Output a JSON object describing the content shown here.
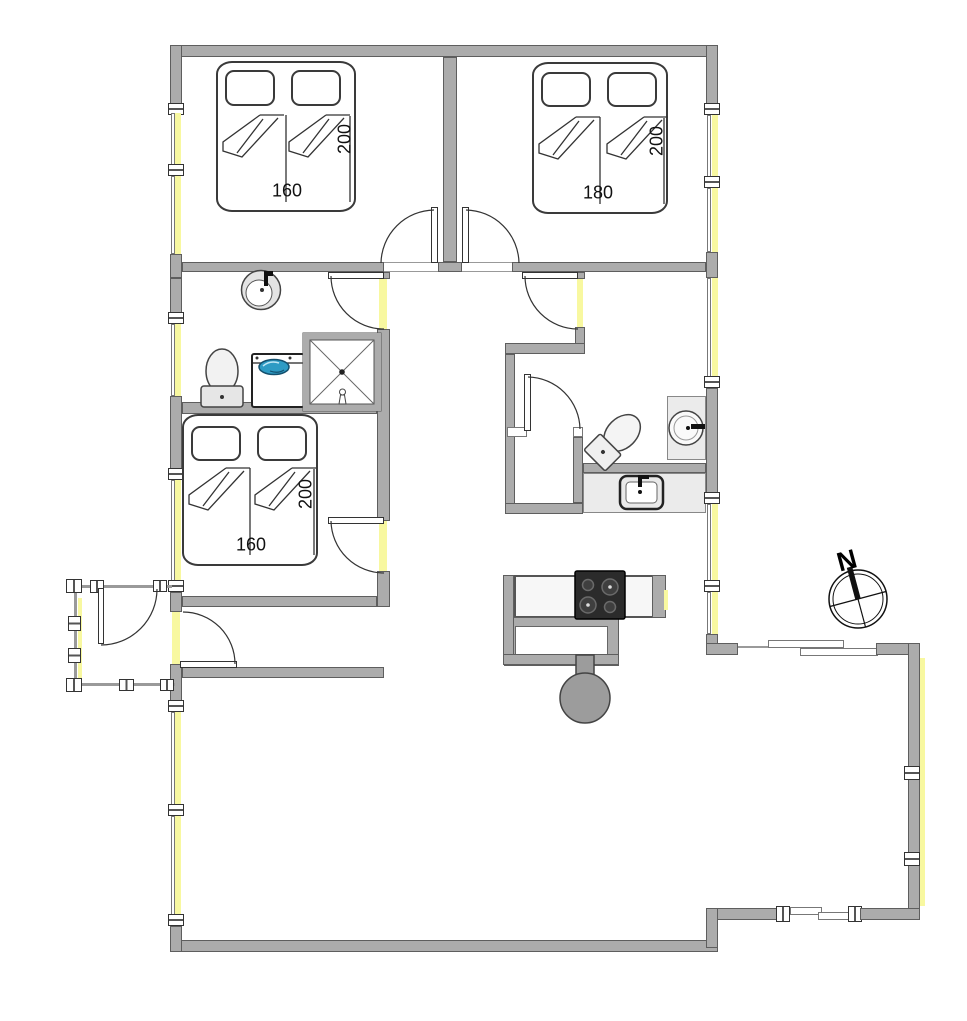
{
  "floorplan": {
    "compass_label": "N",
    "beds": [
      {
        "id": "bed-top-left",
        "width_label": "160",
        "length_label": "200"
      },
      {
        "id": "bed-top-right",
        "width_label": "180",
        "length_label": "200"
      },
      {
        "id": "bed-middle-left",
        "width_label": "160",
        "length_label": "200"
      }
    ],
    "colors": {
      "wall": "#ACACAC",
      "wall_outline": "#5e5e5e",
      "window_light": "#F8F8A0",
      "washer_lid_blue": "#2E9BC4",
      "cooktop_black": "#2B2B2B",
      "stove_gray": "#9C9C9C"
    }
  }
}
